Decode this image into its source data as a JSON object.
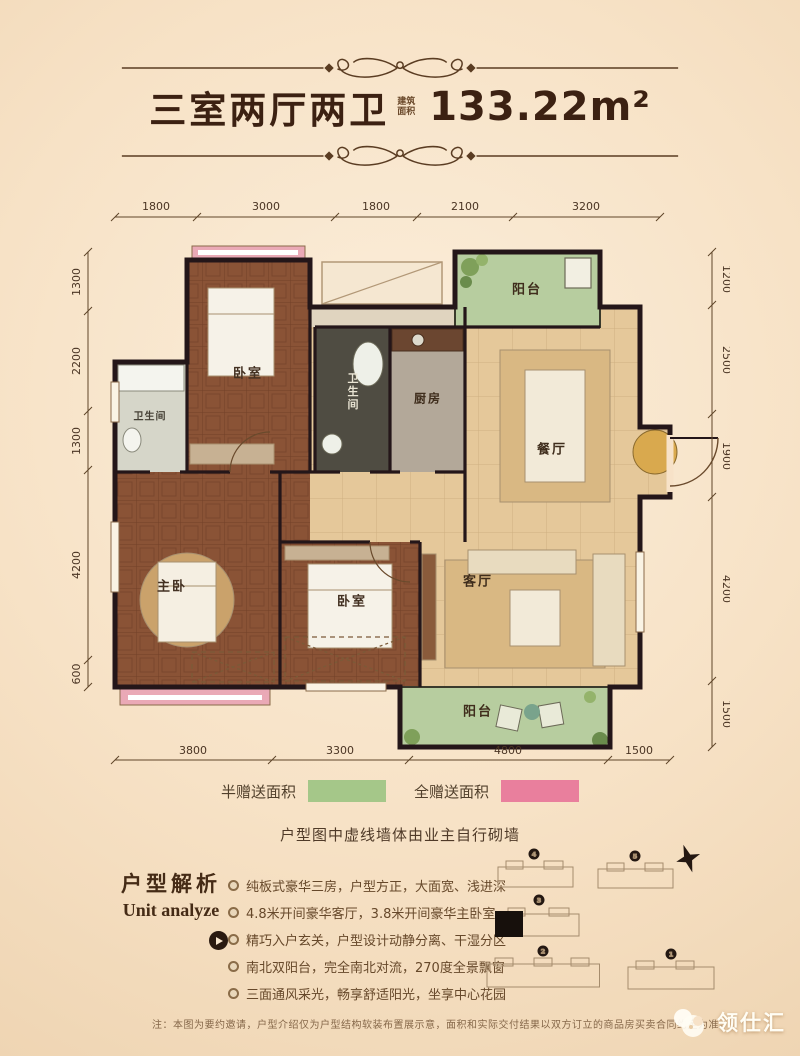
{
  "header": {
    "title_cn": "三室两厅两卫",
    "area_label": "建筑面积",
    "area_value": "133.22m²"
  },
  "plan": {
    "dims_top": [
      "1800",
      "3000",
      "1800",
      "2100",
      "3200"
    ],
    "dims_bottom": [
      "3800",
      "3300",
      "4800",
      "1500"
    ],
    "dims_left": [
      "1300",
      "2200",
      "1300",
      "4200",
      "600"
    ],
    "dims_right": [
      "1200",
      "2500",
      "1900",
      "4200",
      "1500"
    ],
    "rooms": {
      "bedroom1": "卧室",
      "bedroom2": "卧室",
      "master": "主卧",
      "bath1": "卫生间",
      "bath2": "卫生间",
      "kitchen": "厨房",
      "dining": "餐厅",
      "living": "客厅",
      "balcony_top": "阳台",
      "balcony_bottom": "阳台"
    },
    "colors": {
      "wood": "#8a5336",
      "tan": "#e5c89a",
      "balcony_green": "#b7cd9f",
      "bay_pink": "#eaa9b6",
      "bath_dark": "#4f4c42",
      "bath_light": "#d6d6c9",
      "kitchen_gray": "#b3a899",
      "alcove": "#e0d4bf"
    }
  },
  "legend": {
    "items": [
      {
        "label": "半赠送面积",
        "color": "#a5c789"
      },
      {
        "label": "全赠送面积",
        "color": "#e97f9d"
      }
    ],
    "note": "户型图中虚线墙体由业主自行砌墙"
  },
  "analysis": {
    "title_cn": "户型解析",
    "title_en": "Unit analyze",
    "bullets": [
      "纯板式豪华三房，户型方正，大面宽、浅进深",
      "4.8米开间豪华客厅，3.8米开间豪华主卧室",
      "精巧入户玄关，户型设计动静分离、干湿分区",
      "南北双阳台，完全南北对流，270度全景飘窗",
      "三面通风采光，畅享舒适阳光，坐享中心花园"
    ]
  },
  "sitemap": {
    "buildings": [
      {
        "num": "4"
      },
      {
        "num": "5"
      },
      {
        "num": "3"
      },
      {
        "num": "2"
      },
      {
        "num": "1"
      }
    ]
  },
  "footer": {
    "note": "注：本图为要约邀请，户型介绍仅为户型结构软装布置展示意，面积和实际交付结果以双方订立的商品房买卖合同约定为准。",
    "logo": "领仕汇"
  }
}
